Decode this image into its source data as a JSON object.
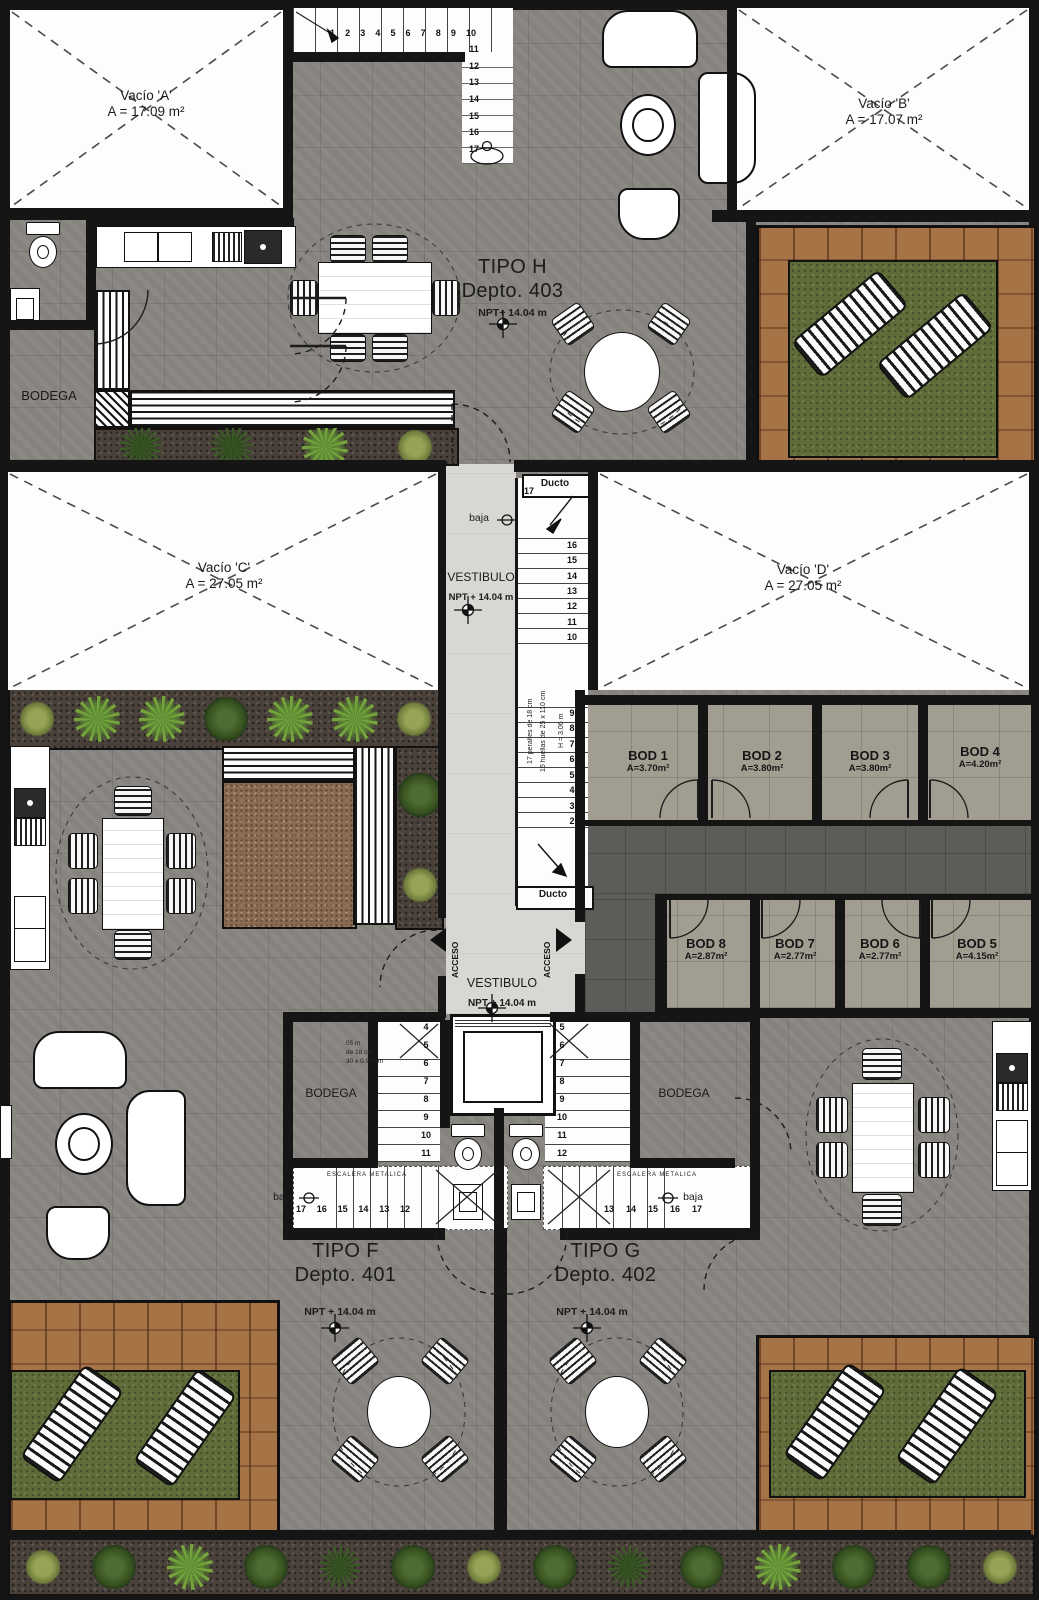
{
  "colors": {
    "wall": "#151515",
    "floor_gray": "#86837e",
    "floor_storage": "#a29d91",
    "corridor": "#5e5c58",
    "vestibule": "#d8d7d3",
    "wood_deck": "#a67347",
    "grass": "#5f6d39",
    "soil": "#49413a",
    "gravel": "#8b6a50",
    "paper_white": "#fdfdfd"
  },
  "voids": {
    "a": {
      "name": "Vacío 'A'",
      "area": "A = 17.09 m²"
    },
    "b": {
      "name": "Vacío 'B'",
      "area": "A = 17.07 m²"
    },
    "c": {
      "name": "Vacío 'C'",
      "area": "A = 27.05 m²"
    },
    "d": {
      "name": "Vacío 'D'",
      "area": "A = 27.05 m²"
    }
  },
  "units": {
    "h": {
      "type": "TIPO H",
      "depto": "Depto. 403",
      "npt": "NPT+ 14.04 m"
    },
    "f": {
      "type": "TIPO F",
      "depto": "Depto. 401",
      "npt": "NPT + 14.04 m"
    },
    "g": {
      "type": "TIPO G",
      "depto": "Depto. 402",
      "npt": "NPT + 14.04 m"
    }
  },
  "labels": {
    "bodega": "BODEGA",
    "vestibulo": "VESTIBULO",
    "vestibulo_npt": "NPT + 14.04 m",
    "ducto": "Ducto",
    "acceso": "ACCESO",
    "baja": "baja",
    "escalera": "ESCALERA METALICA"
  },
  "storage": [
    {
      "name": "BOD 1",
      "area": "A=3.70m²"
    },
    {
      "name": "BOD 2",
      "area": "A=3.80m²"
    },
    {
      "name": "BOD 3",
      "area": "A=3.80m²"
    },
    {
      "name": "BOD 4",
      "area": "A=4.20m²"
    },
    {
      "name": "BOD 5",
      "area": "A=4.15m²"
    },
    {
      "name": "BOD 6",
      "area": "A=2.77m²"
    },
    {
      "name": "BOD 7",
      "area": "A=2.77m²"
    },
    {
      "name": "BOD 8",
      "area": "A=2.87m²"
    }
  ],
  "stairs": {
    "top_run": [
      "1",
      "2",
      "3",
      "4",
      "5",
      "6",
      "7",
      "8",
      "9",
      "10"
    ],
    "top_flight": [
      "11",
      "12",
      "13",
      "14",
      "15",
      "16",
      "17"
    ],
    "mid_top": "17",
    "mid_upper": [
      "16",
      "15",
      "14",
      "13",
      "12",
      "11",
      "10"
    ],
    "mid_lower": [
      "9",
      "8",
      "7",
      "6",
      "5",
      "4",
      "3",
      "2"
    ],
    "mid_note1": "17 peraltes de 18 cm",
    "mid_note2": "16 huellas de 25 x 110 cm",
    "mid_note3": "H = 3.06 m",
    "f_flight": [
      "4",
      "5",
      "6",
      "7",
      "8",
      "9",
      "10",
      "11"
    ],
    "f_run": [
      "17",
      "16",
      "15",
      "14",
      "13",
      "12"
    ],
    "g_flight": [
      "5",
      "6",
      "7",
      "8",
      "9",
      "10",
      "11",
      "12"
    ],
    "g_run": [
      "13",
      "14",
      "15",
      "16",
      "17"
    ],
    "f_note1": "05 m",
    "f_note2": "de 18 cm",
    "f_note3": "30 x 0.90 cm"
  },
  "plants": {
    "top": [
      {
        "variant": "olive"
      },
      {
        "variant": "palm"
      },
      {
        "variant": "palm"
      },
      {
        "variant": "dark"
      },
      {
        "variant": "palm"
      },
      {
        "variant": "palm"
      },
      {
        "variant": "olive"
      }
    ],
    "side": [
      {
        "variant": "dark"
      },
      {
        "variant": "olive"
      }
    ],
    "bench": [
      {
        "variant": "grass-p"
      },
      {
        "variant": "grass-p"
      },
      {
        "variant": "palm"
      },
      {
        "variant": "olive"
      }
    ],
    "bottom": [
      {
        "variant": "olive"
      },
      {
        "variant": "dark"
      },
      {
        "variant": "palm"
      },
      {
        "variant": "dark"
      },
      {
        "variant": "grass-p"
      },
      {
        "variant": "dark"
      },
      {
        "variant": "olive"
      },
      {
        "variant": "dark"
      },
      {
        "variant": "grass-p"
      },
      {
        "variant": "dark"
      },
      {
        "variant": "palm"
      },
      {
        "variant": "dark"
      },
      {
        "variant": "dark"
      },
      {
        "variant": "olive"
      }
    ]
  }
}
